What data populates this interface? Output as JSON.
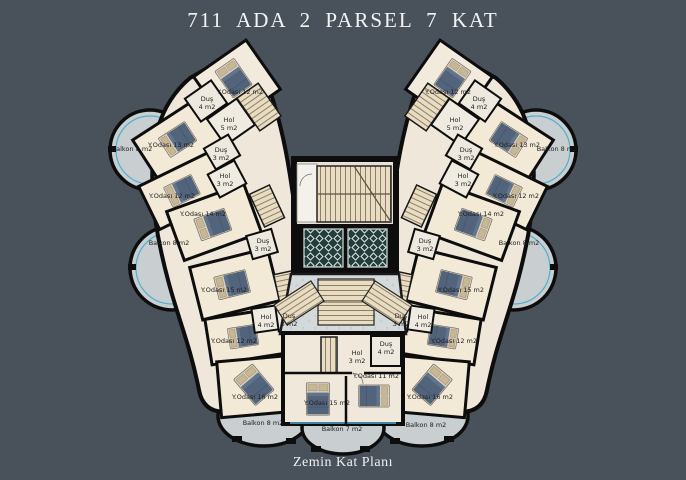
{
  "title": "711 ADA 2 PARSEL 7 KAT",
  "caption": "Zemin Kat Planı",
  "colors": {
    "background": "#49525a",
    "walls": "#0d0d0d",
    "room_floor": "#f0e8db",
    "balcony": "#c9ced1",
    "balcony_accent_teal": "#4fb0cf",
    "bed_duvet": "#52647b",
    "stair_tread": "#e8dcc2",
    "elevator": "#223d3b",
    "title_text": "#f2f3f4"
  },
  "rooms": {
    "left": [
      "Y.Odası 12 m2",
      "Duş\n4 m2",
      "Hol\n5 m2",
      "Y.Odası 13 m2",
      "Balkon 8 m2",
      "Duş\n3 m2",
      "Hol\n3 m2",
      "Y.Odası 12 m2",
      "Y.Odası 14 m2",
      "Balkon 8 m2",
      "Duş\n3 m2",
      "Y.Odası 15 m2",
      "Hol\n4 m2",
      "Duş\n3 m2",
      "Y.Odası 12 m2",
      "Y.Odası 16 m2",
      "Balkon 8 m2"
    ],
    "center": [
      "Hol\n3 m2",
      "Duş\n4 m2",
      "Y.Odası 11 m2",
      "Y.Odası 15 m2",
      "Balkon 7 m2"
    ],
    "right": [
      "Y.Odası 12 m2",
      "Duş\n4 m2",
      "Hol\n5 m2",
      "Y.Odası 13 m2",
      "Balkon 8 m2",
      "Duş\n3 m2",
      "Hol\n3 m2",
      "Y.Odası 12 m2",
      "Y.Odası 14 m2",
      "Balkon 8 m2",
      "Duş\n3 m2",
      "Y.Odası 15 m2",
      "Hol\n4 m2",
      "Duş\n3 m2",
      "Y.Odası 12 m2",
      "Y.Odası 16 m2",
      "Balkon 8 m2"
    ]
  }
}
